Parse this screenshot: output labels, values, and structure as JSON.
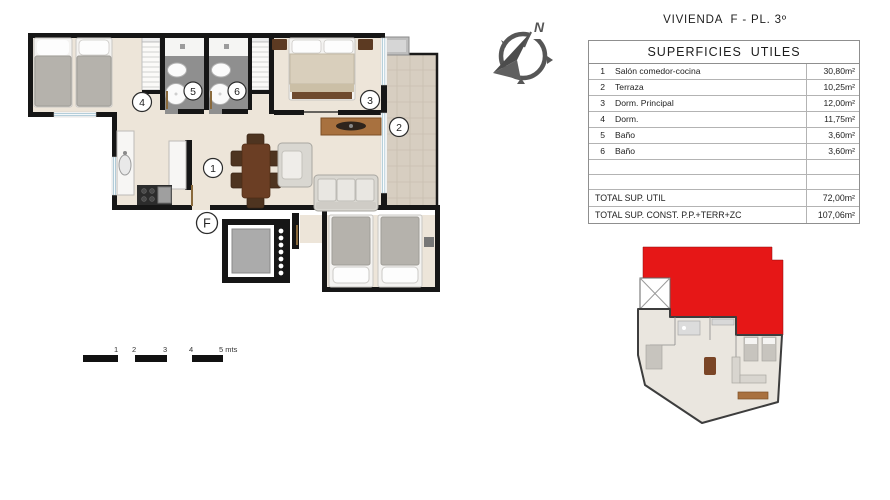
{
  "header": {
    "title": "VIVIENDA  F - PL. 3º"
  },
  "table": {
    "header": "SUPERFICIES  UTILES",
    "rows": [
      {
        "num": "1",
        "label": "Salón comedor-cocina",
        "value": "30,80m²"
      },
      {
        "num": "2",
        "label": "Terraza",
        "value": "10,25m²"
      },
      {
        "num": "3",
        "label": "Dorm. Principal",
        "value": "12,00m²"
      },
      {
        "num": "4",
        "label": "Dorm.",
        "value": "11,75m²"
      },
      {
        "num": "5",
        "label": "Baño",
        "value": "3,60m²"
      },
      {
        "num": "6",
        "label": "Baño",
        "value": "3,60m²"
      }
    ],
    "totals": [
      {
        "label": "TOTAL SUP. UTIL",
        "value": "72,00m²"
      },
      {
        "label": "TOTAL SUP. CONST. P.P.+TERR+ZC",
        "value": "107,06m²"
      }
    ]
  },
  "plan": {
    "labels": {
      "living": "1",
      "terrace": "2",
      "dorm_principal": "3",
      "dorm": "4",
      "bath5": "5",
      "bath6": "6",
      "unit": "F"
    }
  },
  "compass": {
    "north": "N"
  },
  "scale_bar": {
    "labels": [
      "1",
      "2",
      "3",
      "4",
      "5 mts"
    ]
  },
  "colors": {
    "highlight_red": "#e61717",
    "wall_black": "#161616",
    "floor_cream": "#ede5d9",
    "terrace_tile": "#d7cec1",
    "bath_gray": "#8f8f8f",
    "window_blue": "#aac7d4"
  }
}
